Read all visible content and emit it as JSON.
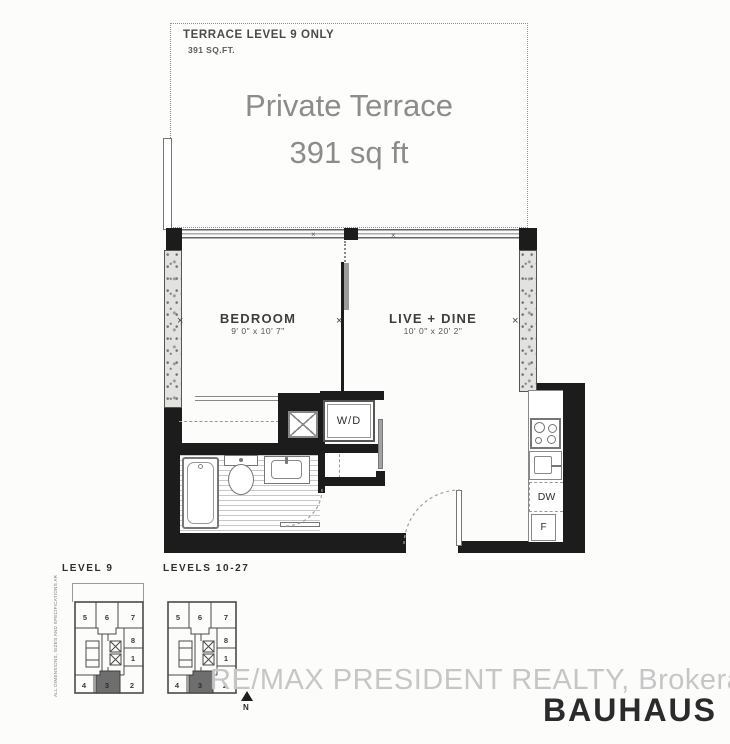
{
  "terrace": {
    "tag_title": "TERRACE LEVEL 9 ONLY",
    "tag_area": "391 SQ.FT.",
    "main_line1": "Private Terrace",
    "main_line2": "391 sq ft"
  },
  "rooms": {
    "bedroom": {
      "name": "BEDROOM",
      "dims": "9' 0\" x 10' 7\""
    },
    "live_dine": {
      "name": "LIVE + DINE",
      "dims": "10' 0\" x 20' 2\""
    }
  },
  "appliances": {
    "washer_dryer": "W/D",
    "dishwasher": "DW",
    "fridge": "F"
  },
  "keyplans": {
    "plan1_label": "LEVEL 9",
    "plan2_label": "LEVELS 10-27",
    "units": {
      "u5": "5",
      "u6": "6",
      "u7": "7",
      "u8": "8",
      "u1": "1",
      "u4": "4",
      "u3": "3",
      "u2": "2"
    }
  },
  "compass": {
    "north": "N"
  },
  "footer": {
    "watermark": "RE/MAX PRESIDENT REALTY, Brokerage",
    "brand": "BAUHAUS"
  },
  "disclaimer": "ALL DIMENSIONS, SIZES AND SPECIFICATIONS ARE APPROXIMATE AND SUBJECT TO CHANGE WITHOUT NOTICE. E. & O. E.",
  "colors": {
    "wall_black": "#1c1c1c",
    "concrete_gray": "#e2e2df",
    "terrace_text_gray": "#8c8c8c",
    "watermark_gray": "#c6c6c6",
    "brand_dark": "#2b2b2e",
    "highlight_unit_gray": "#6e6e6e"
  }
}
